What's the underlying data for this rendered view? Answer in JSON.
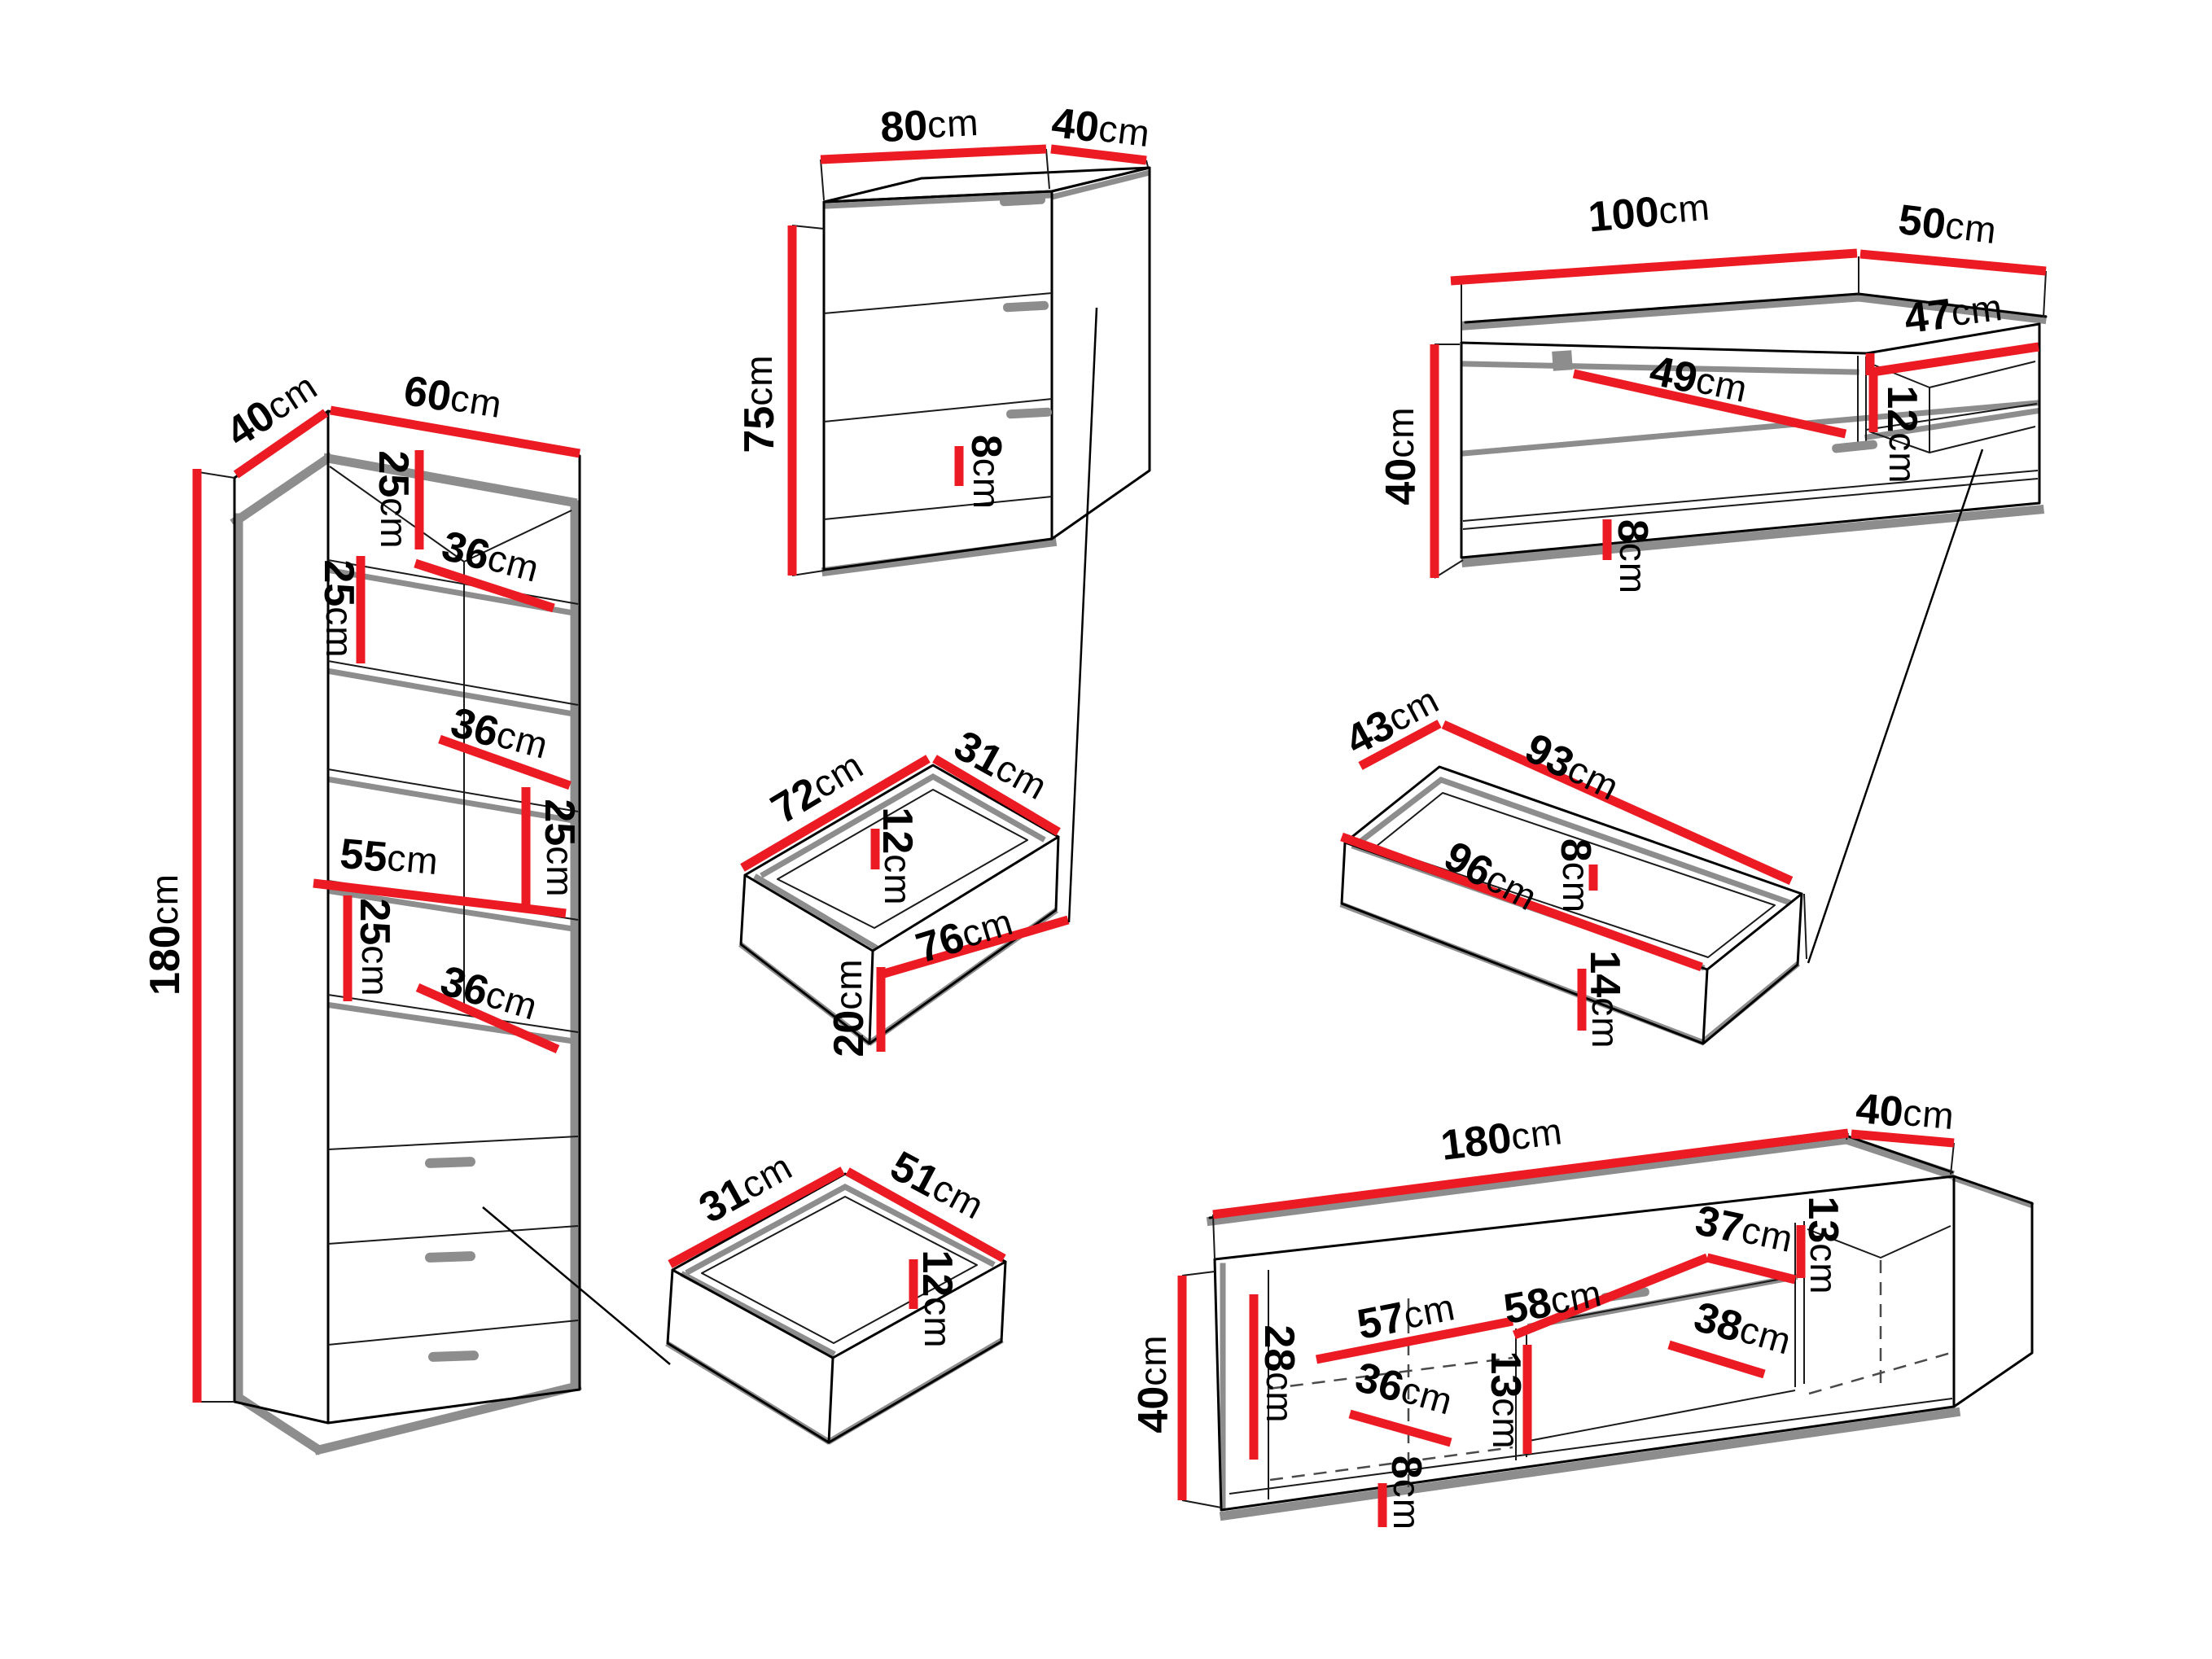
{
  "title": "furniture set dimension diagram",
  "unit": "cm",
  "colors": {
    "dimension_line": "#ec1b23",
    "outline": "#000000",
    "shadow_edge": "#8d8d8d",
    "background": "#ffffff"
  },
  "dims": {
    "bookcase": {
      "depth": "40",
      "width": "60",
      "height": "180",
      "gap1": "25",
      "shelf1": "36",
      "gap2": "25",
      "shelf2": "36",
      "gap3": "25",
      "shelf3": "55",
      "gap4": "25",
      "shelf4": "36"
    },
    "chest": {
      "width": "80",
      "depth": "40",
      "height": "75",
      "plinth": "8"
    },
    "tv_cabinet": {
      "width": "100",
      "depth": "50",
      "height": "40",
      "shelf": "47",
      "door": "49",
      "shelf_gap": "12",
      "plinth": "8"
    },
    "drawer_medium": {
      "length": "72",
      "depth": "31",
      "inner": "12",
      "front": "76",
      "height": "20"
    },
    "drawer_long": {
      "depth": "43",
      "length": "93",
      "front": "96",
      "inner": "8",
      "height": "14"
    },
    "drawer_small": {
      "depth": "31",
      "length": "51",
      "inner": "12"
    },
    "tv_stand": {
      "width": "180",
      "depth": "40",
      "height": "40",
      "inner_height": "28",
      "left_width": "57",
      "drawer_width": "58",
      "right_width": "37",
      "lower_width": "38",
      "shelf_width": "36",
      "divider_left": "13",
      "divider_right": "13",
      "plinth": "8"
    }
  }
}
